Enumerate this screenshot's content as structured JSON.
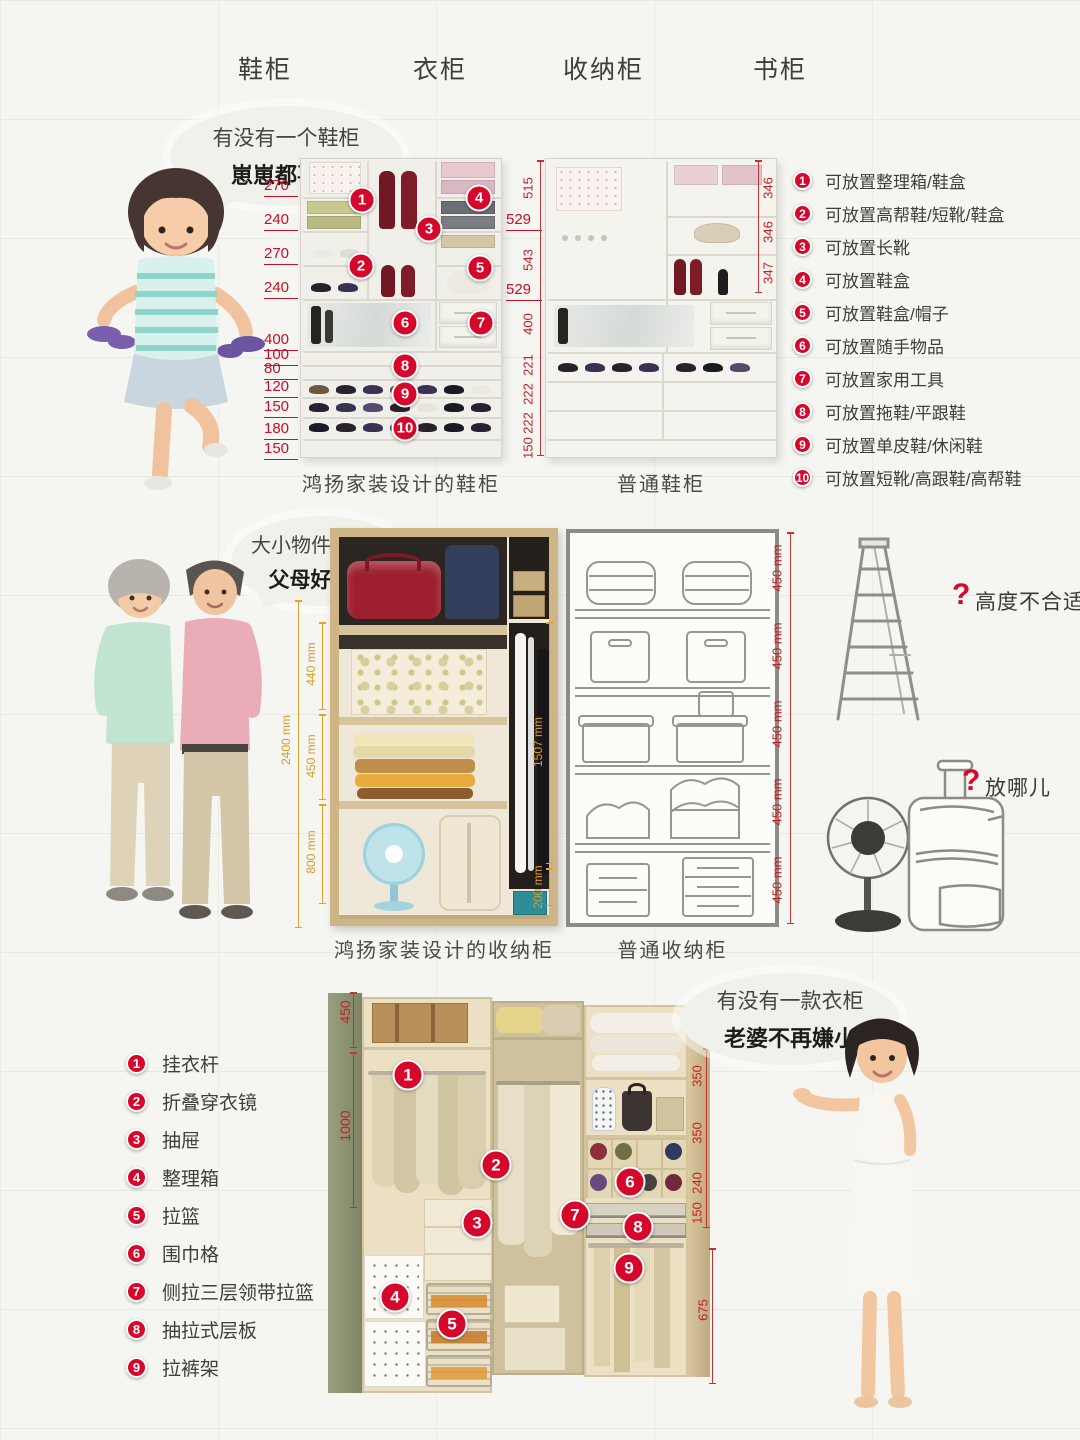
{
  "accent": {
    "red": "#d5082b",
    "orange": "#e0a42e"
  },
  "nav": {
    "items": [
      "鞋柜",
      "衣柜",
      "收纳柜",
      "书柜"
    ]
  },
  "shoe": {
    "bubble": {
      "line1": "有没有一个鞋柜",
      "line2": "崽崽都喜欢"
    },
    "designed": {
      "caption": "鸿扬家装设计的鞋柜",
      "dims_left": [
        "270",
        "240",
        "270",
        "240",
        "400",
        "100",
        "80",
        "120",
        "150",
        "180",
        "150"
      ],
      "dims_right": [
        "529",
        "529"
      ],
      "badges": [
        "1",
        "2",
        "3",
        "4",
        "5",
        "6",
        "7",
        "8",
        "9",
        "10"
      ]
    },
    "ordinary": {
      "caption": "普通鞋柜",
      "dims_left": [
        "515",
        "543",
        "400",
        "221",
        "222",
        "222",
        "150"
      ],
      "dims_right": [
        "346",
        "346",
        "347"
      ]
    },
    "legend": [
      {
        "num": "1",
        "label": "可放置整理箱/鞋盒"
      },
      {
        "num": "2",
        "label": "可放置高帮鞋/短靴/鞋盒"
      },
      {
        "num": "3",
        "label": "可放置长靴"
      },
      {
        "num": "4",
        "label": "可放置鞋盒"
      },
      {
        "num": "5",
        "label": "可放置鞋盒/帽子"
      },
      {
        "num": "6",
        "label": "可放置随手物品"
      },
      {
        "num": "7",
        "label": "可放置家用工具"
      },
      {
        "num": "8",
        "label": "可放置拖鞋/平跟鞋"
      },
      {
        "num": "9",
        "label": "可放置单皮鞋/休闲鞋"
      },
      {
        "num": "10",
        "label": "可放置短靴/高跟鞋/高帮鞋"
      }
    ]
  },
  "storage": {
    "bubble": {
      "line1": "大小物件全收纳",
      "line2": "父母好中意"
    },
    "designed": {
      "caption": "鸿扬家装设计的收纳柜",
      "dim_outer": "2400 mm",
      "dims_left": [
        "440 mm",
        "450 mm",
        "800 mm"
      ],
      "dims_right": [
        "1507 mm",
        "200 mm"
      ]
    },
    "ordinary": {
      "caption": "普通收纳柜",
      "dims_right": [
        "450 mm",
        "450 mm",
        "450 mm",
        "450 mm",
        "450 mm"
      ]
    },
    "q_height": {
      "mark": "?",
      "text": "高度不合适"
    },
    "q_where": {
      "mark": "?",
      "text": "放哪儿"
    }
  },
  "wardrobe": {
    "bubble": {
      "line1": "有没有一款衣柜",
      "line2": "老婆不再嫌小"
    },
    "legend": [
      {
        "num": "1",
        "label": "挂衣杆"
      },
      {
        "num": "2",
        "label": "折叠穿衣镜"
      },
      {
        "num": "3",
        "label": "抽屉"
      },
      {
        "num": "4",
        "label": "整理箱"
      },
      {
        "num": "5",
        "label": "拉篮"
      },
      {
        "num": "6",
        "label": "围巾格"
      },
      {
        "num": "7",
        "label": "侧拉三层领带拉篮"
      },
      {
        "num": "8",
        "label": "抽拉式层板"
      },
      {
        "num": "9",
        "label": "拉裤架"
      }
    ],
    "dims_left": [
      "450",
      "1000"
    ],
    "dims_right": [
      "350",
      "350",
      "240",
      "150",
      "675"
    ],
    "badges": [
      "1",
      "2",
      "3",
      "4",
      "5",
      "6",
      "7",
      "8",
      "9"
    ]
  },
  "images": {
    "girl": "girl-holding-shoes",
    "couple": "elderly-couple",
    "woman": "woman-presenting",
    "ladder": "ladder-sketch",
    "fan_photo": "blue-fan",
    "fan_sketch": "electric-fan-sketch",
    "suitcase_sketch": "suitcase-sketch"
  }
}
